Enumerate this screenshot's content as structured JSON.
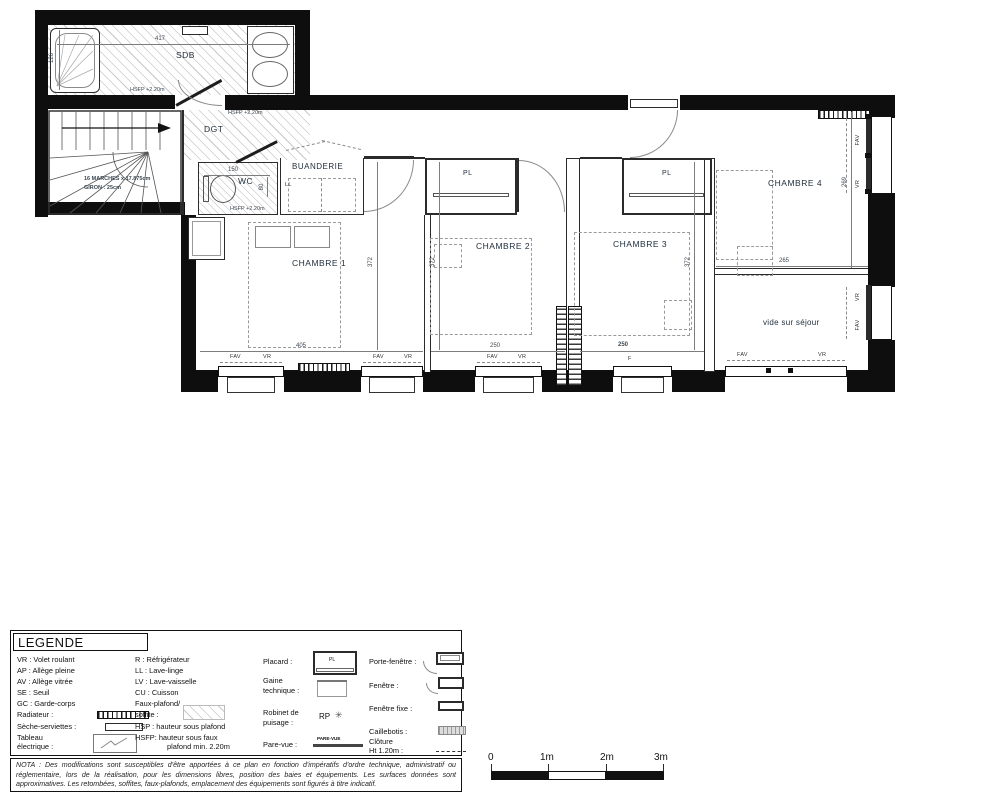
{
  "plan": {
    "room_labels": {
      "sdb": "SDB",
      "dgt": "DGT",
      "wc": "WC",
      "buanderie": "BUANDERIE",
      "ll": "LL",
      "ch1": "CHAMBRE 1",
      "ch2": "CHAMBRE 2",
      "ch3": "CHAMBRE 3",
      "ch4": "CHAMBRE 4",
      "pl": "PL",
      "vide": "vide sur séjour"
    },
    "dims": {
      "w417": "417",
      "h126": "126",
      "w150": "150",
      "h80": "80",
      "w405": "405",
      "w250": "250",
      "h372": "372",
      "h269": "269",
      "w265": "265"
    },
    "notes": {
      "hsfp": "HSFP +2.20m",
      "stair1": "16 MARCHES x 17.875cm",
      "stair2": "GIRON : 25cm"
    },
    "window_labels": {
      "fav": "FAV",
      "vr": "VR",
      "f": "F"
    }
  },
  "legend": {
    "title": "LEGENDE",
    "col1": [
      "VR : Volet roulant",
      "AP : Allège pleine",
      "AV : Allège vitrée",
      "SE : Seuil",
      "GC : Garde-corps",
      "Radiateur :",
      "Sèche-serviettes :",
      "Tableau",
      "électrique :"
    ],
    "col2": [
      "R : Réfrigérateur",
      "LL : Lave-linge",
      "LV : Lave-vaisselle",
      "CU : Cuisson",
      "Faux-plafond/",
      "soffite :",
      "HSP : hauteur sous plafond",
      "HSFP: hauteur sous faux",
      "plafond min. 2.20m"
    ],
    "col3": [
      "Placard :",
      "Gaine",
      "technique :",
      "Robinet de",
      "puisage :",
      "Pare-vue :"
    ],
    "col4": [
      "Porte-fenêtre :",
      "Fenêtre :",
      "Fenêtre fixe :",
      "Caillebotis :",
      "Clôture",
      "Ht 1.20m :"
    ],
    "symbols": {
      "placard": "PL",
      "robinet": "RP",
      "parevue": "PARE-VUE"
    }
  },
  "nota": "NOTA : Des modifications sont susceptibles d'être apportées à ce plan en fonction d'impératifs d'ordre technique, administratif ou réglementaire, lors de la réalisation, pour les dimensions libres, position des baies et équipements. Les surfaces données sont approximatives. Les retombées, soffites, faux-plafonds, emplacement des équipements sont figurés à titre indicatif.",
  "scale": {
    "t0": "0",
    "t1": "1m",
    "t2": "2m",
    "t3": "3m"
  }
}
